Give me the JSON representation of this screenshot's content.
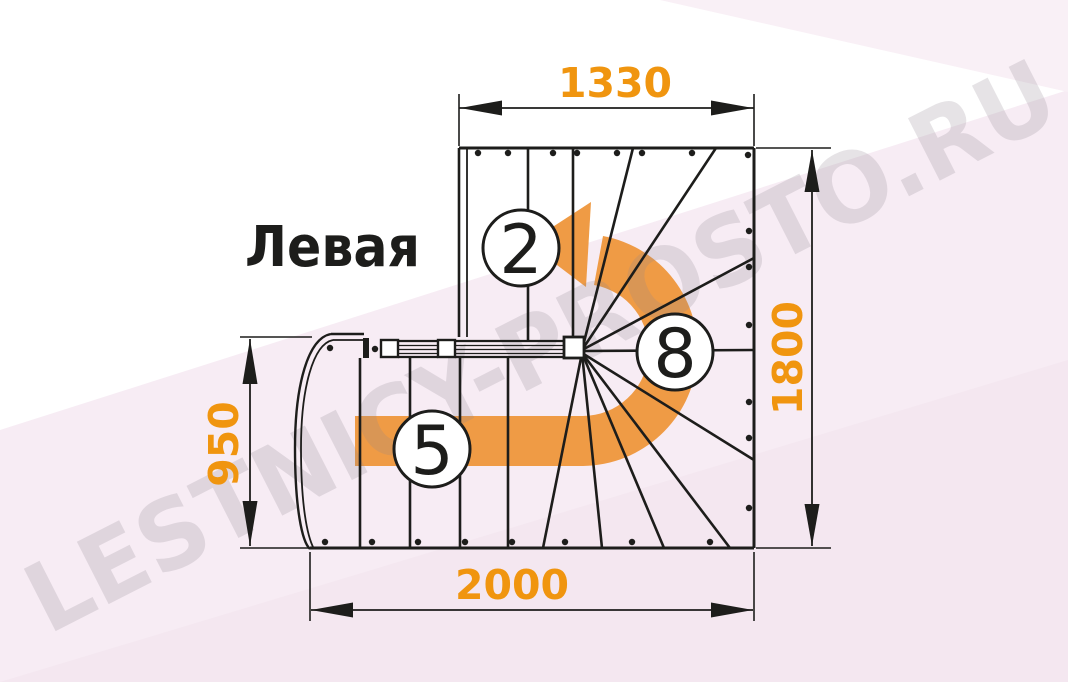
{
  "drawing": {
    "type": "staircase-floor-plan",
    "orientation_label": "Левая",
    "watermark": "LESTNICY-PROSTO.RU",
    "dimensions": {
      "top": "1330",
      "right": "1800",
      "left": "950",
      "bottom": "2000"
    },
    "step_numbers": {
      "upper_flight": "2",
      "lower_flight": "5",
      "winder": "8"
    },
    "colors": {
      "line": "#1d1d1b",
      "dimension_text": "#F0950F",
      "direction_arrow": "#EF9B45",
      "background_tint": "#f7ecf4",
      "background_tint_dark": "#f2e3ec",
      "background_tint_light": "#f9f0f6",
      "watermark": "#8f8590"
    }
  }
}
